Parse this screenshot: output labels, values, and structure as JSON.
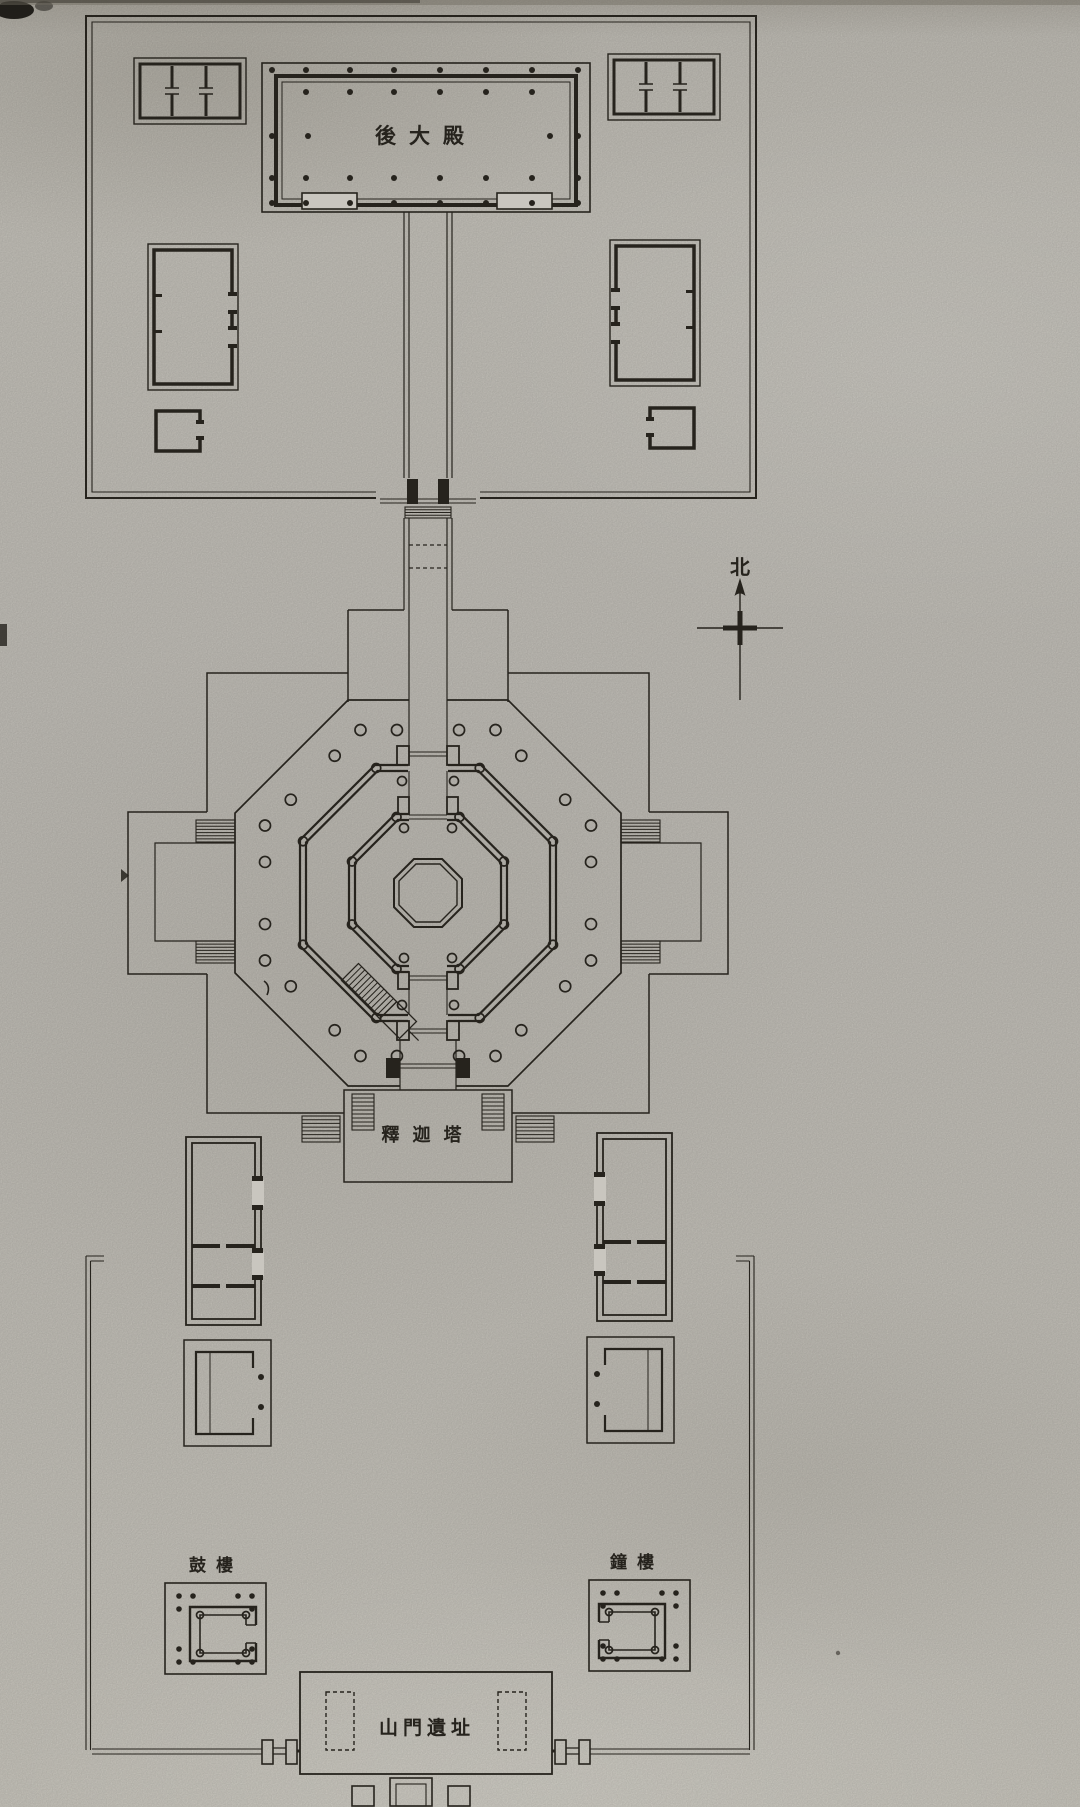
{
  "plan": {
    "kind": "temple-site-plan",
    "labels": {
      "rear_hall": "後大殿",
      "pagoda": "釋迦塔",
      "drum_tower": "鼓樓",
      "bell_tower": "鐘樓",
      "gate_ruins": "山門遺址"
    },
    "north_indicator": {
      "label": "北"
    }
  },
  "colors": {
    "paper": "#c9c6bf",
    "ink": "#26231d"
  }
}
